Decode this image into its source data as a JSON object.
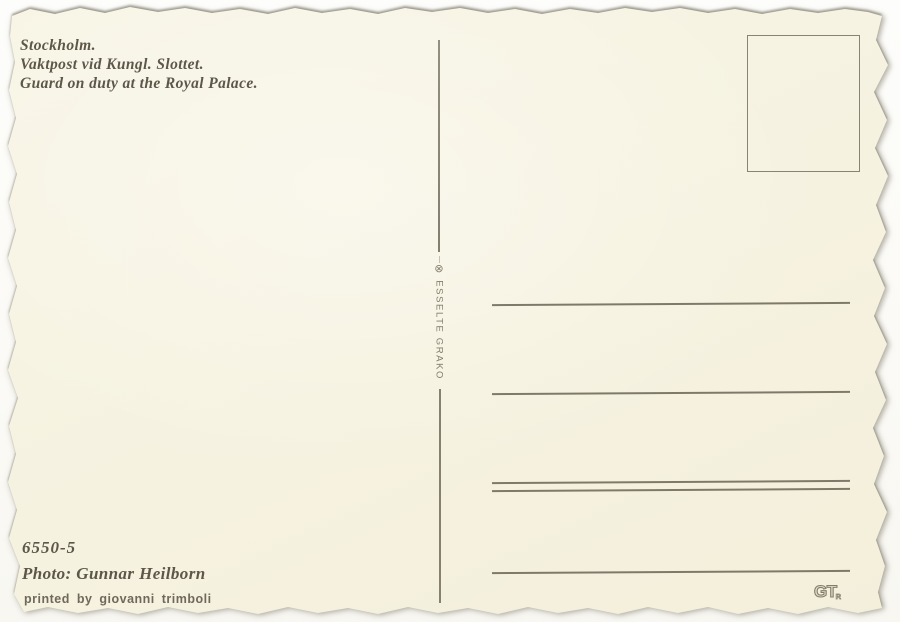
{
  "postcard": {
    "caption": {
      "title_sv": "Stockholm.",
      "subtitle_sv": "Vaktpost vid Kungl. Slottet.",
      "subtitle_en": "Guard on duty at the Royal Palace."
    },
    "printer_mark": {
      "symbol": "⊗",
      "name": "ESSELTE GRAKO"
    },
    "footer": {
      "catalog_number": "6550-5",
      "photo_credit": "Photo: Gunnar Heilborn",
      "printed_by": "printed by giovanni trimboli"
    },
    "printer_logo": {
      "letters": "GT",
      "registered": "R"
    },
    "colors": {
      "card": "#f6f2e0",
      "backdrop": "#fcfbf8",
      "ink": "#5d574a",
      "rule": "#7f796a"
    }
  }
}
